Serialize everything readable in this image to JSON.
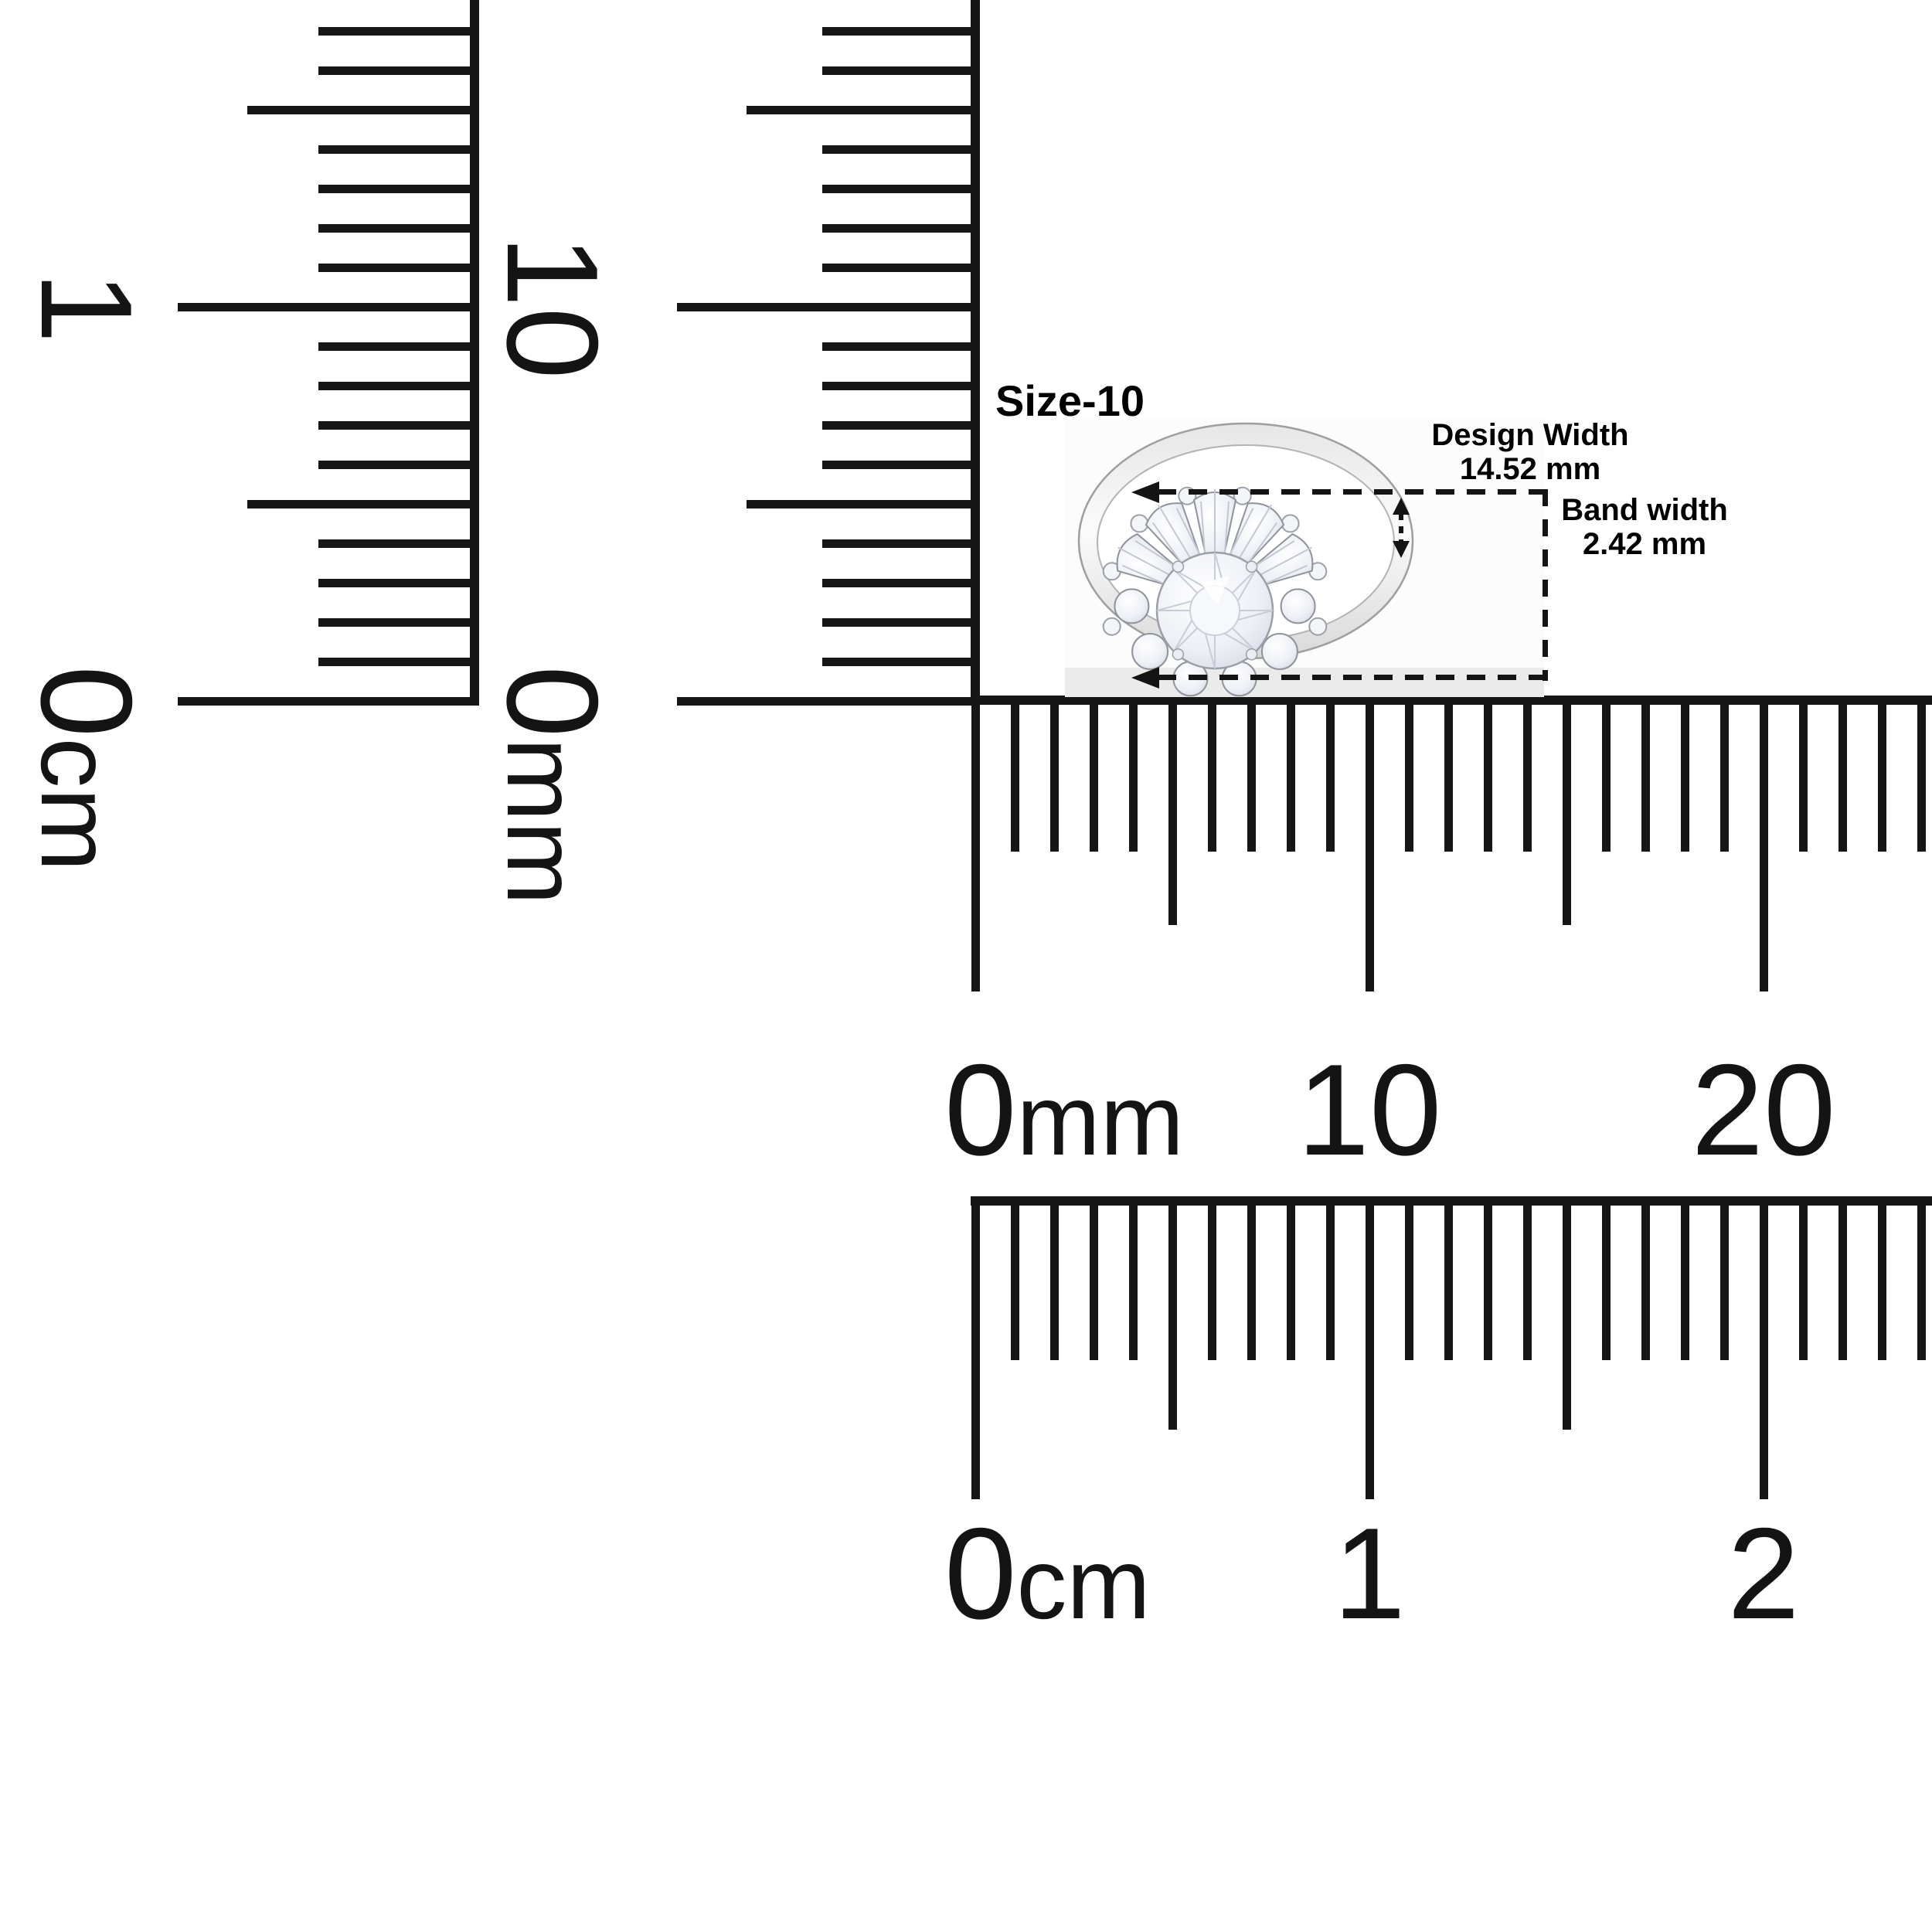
{
  "page": {
    "background": "#ffffff",
    "ink_color": "#141414"
  },
  "ring": {
    "size_label": "Size-10",
    "metal_color_light": "#fbfbfb",
    "metal_color_dark": "#d9d9d9",
    "annotations": [
      {
        "label": "Design Width",
        "value": "14.52 mm"
      },
      {
        "label": "Band width",
        "value": "2.42 mm"
      }
    ]
  },
  "rulers": {
    "left_cm": {
      "title": "vertical centimeter ruler",
      "zero": "0",
      "suffix": "cm",
      "major_1": "1"
    },
    "left_mm": {
      "title": "vertical millimeter ruler",
      "zero": "0",
      "suffix": "mm",
      "major_1": "10"
    },
    "bottom_mm": {
      "title": "horizontal millimeter ruler",
      "zero": "0",
      "suffix": "mm",
      "major_1": "10",
      "major_2": "20"
    },
    "bottom_cm": {
      "title": "horizontal centimeter ruler",
      "zero": "0",
      "suffix": "cm",
      "major_1": "1",
      "major_2": "2"
    }
  }
}
